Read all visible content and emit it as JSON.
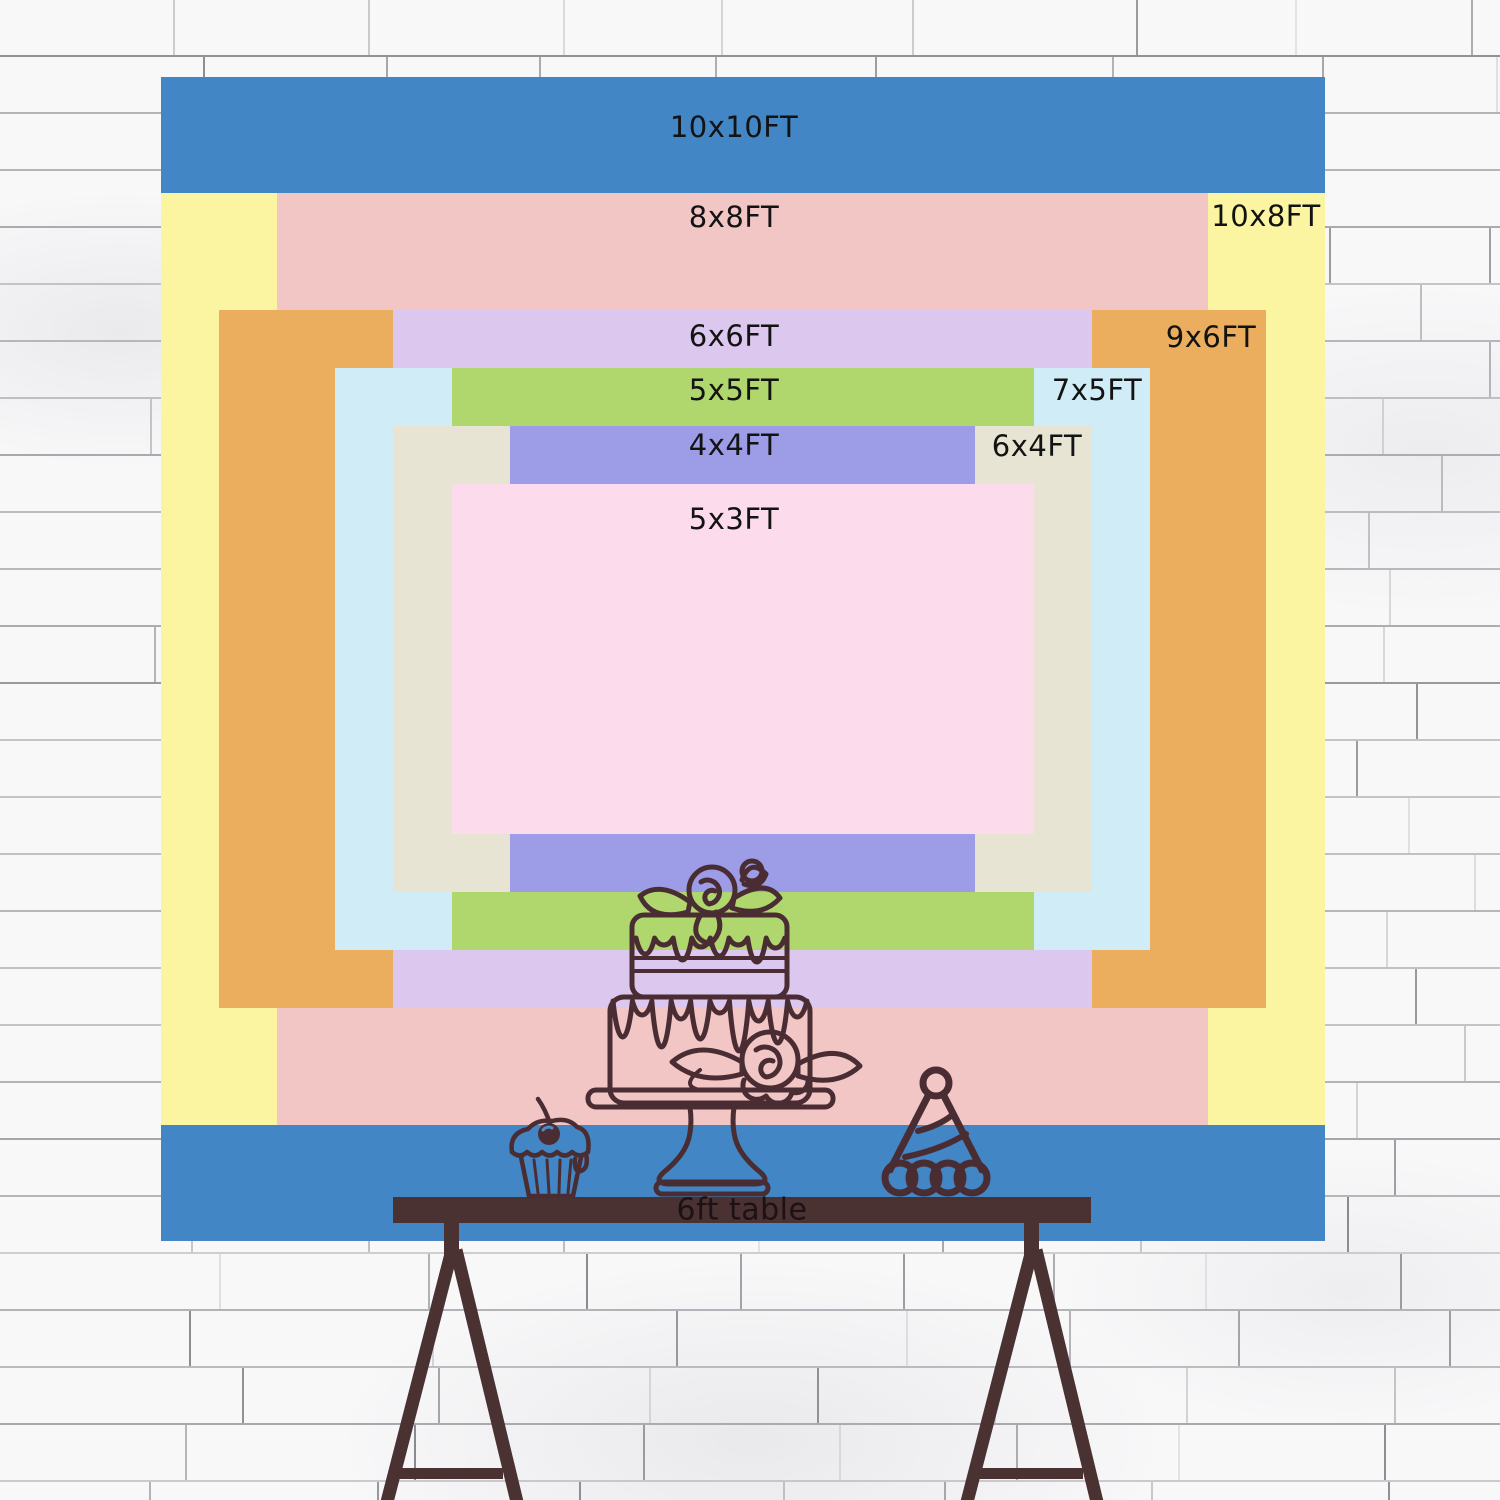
{
  "banner": {
    "label_color": "#131313",
    "sizes": [
      {
        "id": "10x10",
        "label": "10x10FT",
        "width_ft": 10,
        "height_ft": 10,
        "color": "#4286c5",
        "label_placement": "top-center"
      },
      {
        "id": "10x8",
        "label": "10x8FT",
        "width_ft": 10,
        "height_ft": 8,
        "color": "#fbf4a1",
        "label_placement": "right-column"
      },
      {
        "id": "8x8",
        "label": "8x8FT",
        "width_ft": 8,
        "height_ft": 8,
        "color": "#f3c6c6",
        "label_placement": "top-center"
      },
      {
        "id": "9x6",
        "label": "9x6FT",
        "width_ft": 9,
        "height_ft": 6,
        "color": "#eaae5e",
        "label_placement": "right-column"
      },
      {
        "id": "6x6",
        "label": "6x6FT",
        "width_ft": 6,
        "height_ft": 6,
        "color": "#dcc7ef",
        "label_placement": "top-center"
      },
      {
        "id": "7x5",
        "label": "7x5FT",
        "width_ft": 7,
        "height_ft": 5,
        "color": "#d0ecf7",
        "label_placement": "right-column"
      },
      {
        "id": "5x5",
        "label": "5x5FT",
        "width_ft": 5,
        "height_ft": 5,
        "color": "#b0d76d",
        "label_placement": "top-center"
      },
      {
        "id": "6x4",
        "label": "6x4FT",
        "width_ft": 6,
        "height_ft": 4,
        "color": "#e8e4d4",
        "label_placement": "right-column"
      },
      {
        "id": "4x4",
        "label": "4x4FT",
        "width_ft": 4,
        "height_ft": 4,
        "color": "#9c9ce7",
        "label_placement": "top-center"
      },
      {
        "id": "5x3",
        "label": "5x3FT",
        "width_ft": 5,
        "height_ft": 3,
        "color": "#fcdcec",
        "label_placement": "top-center"
      }
    ]
  },
  "table": {
    "label": "6ft table",
    "label_color": "#1c1114",
    "wood_color": "#4a3132"
  },
  "doodles": {
    "line_color": "#4a2d33",
    "items": [
      "cupcake-with-cherry",
      "two-tier-rose-cake-on-stand",
      "party-hat"
    ]
  },
  "wall": {
    "base_color": "#f8f8f9",
    "mortar_line_color": "#3c3c46"
  }
}
